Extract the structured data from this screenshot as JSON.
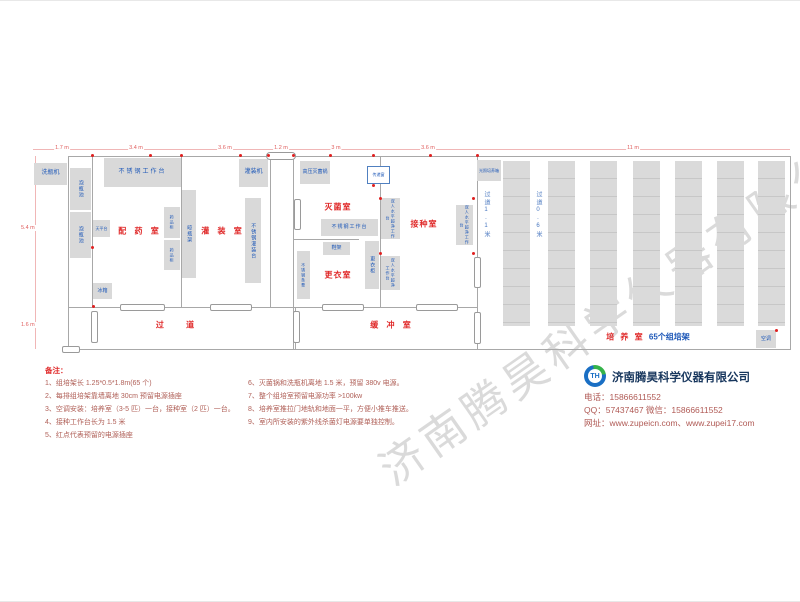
{
  "watermark": "济南腾昊科学仪器有限公司",
  "dims": {
    "top": [
      "1.7 m",
      "3.4 m",
      "3.6 m",
      "1.2 m",
      "3 m",
      "3.6 m",
      "11 m"
    ],
    "left": [
      "5.4 m",
      "1.6 m"
    ]
  },
  "rooms": {
    "peiyao": "配 药 室",
    "guanzhuang": "灌 装 室",
    "miejun": "灭菌室",
    "gengyi": "更衣室",
    "jiezhong": "接种室",
    "guodao": "过    道",
    "huanchong": "缓 冲 室",
    "peiyang": "培 养 室",
    "peiyang_racks": "65个组培架",
    "aisle_1_1": "过道1.1米",
    "aisle_0_6": "过道0.6米"
  },
  "equipment": {
    "xipingji": "洗瓶机",
    "paopingchi1": "泡瓶池",
    "paopingchi2": "泡瓶池",
    "worktable1": "不锈钢工作台",
    "tianpingtai": "天平台",
    "bingxiang": "冰箱",
    "yaopingui1": "药品柜",
    "yaopingui2": "药品柜",
    "liangpingjia": "晾瓶架",
    "guanzhuangji": "灌装机",
    "guanzhuangtai": "不锈钢灌装台",
    "gaoyamiejunguo": "高压灭菌锅",
    "chuandichuang": "传递窗",
    "worktable2": "不锈钢工作台",
    "xiejia": "鞋架",
    "gengyigui": "更衣柜",
    "tiaodeng": "不锈钢条凳",
    "chaojing1": "双人水平超净工作台",
    "chaojing2": "双人水平超净工作台",
    "chaojing3": "双人水平超净工作台",
    "guangzhaoxiang": "光照培养箱",
    "kongtiao": "空调"
  },
  "notes": {
    "title": "备注：",
    "items": [
      "1、组培架长 1.25*0.5*1.8m(65 个)",
      "2、每排组培架靠墙离地 30cm 预留电源插座",
      "3、空调安装：培养室（3-5 匹）一台，接种室（2 匹）一台。",
      "4、接种工作台长为 1.5 米",
      "5、红点代表预留的电源插座",
      "6、灭菌锅和洗瓶机离地 1.5 米，预留 380v 电源。",
      "7、整个组培室预留电源功率 >100kw",
      "8、培养室推拉门地轨和地面一平，方便小推车推送。",
      "9、室内所安装的紫外线杀菌灯电源要单独控制。"
    ]
  },
  "company": {
    "logo_text": "TH",
    "name": "济南腾昊科学仪器有限公司",
    "phone": "电话：15866611552",
    "qq_wechat": "QQ：57437467    微信：15866611552",
    "web": "网址：www.zupeicn.com、www.zupei17.com"
  }
}
